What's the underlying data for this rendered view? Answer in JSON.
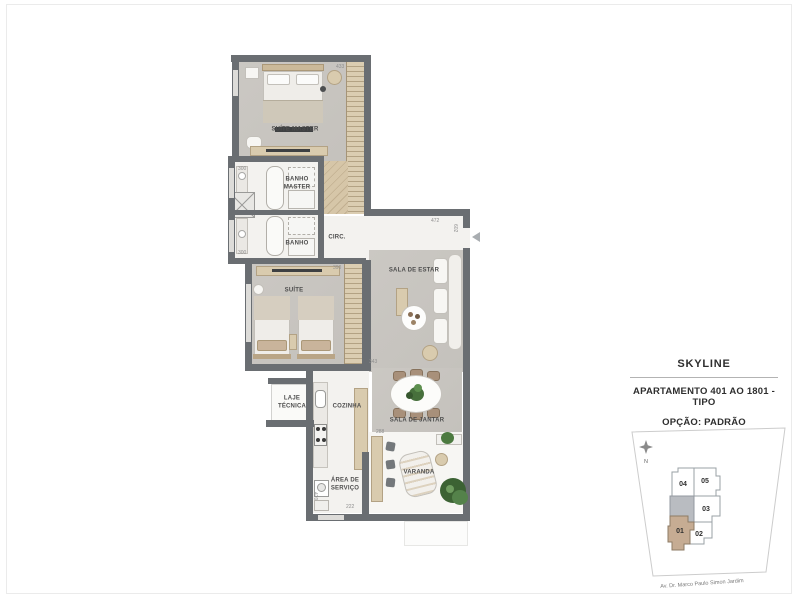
{
  "title_block": {
    "project_name": "SKYLINE",
    "apartment_line": "APARTAMENTO 401 AO 1801 - TIPO",
    "option_line": "OPÇÃO: PADRÃO"
  },
  "floor_plan": {
    "rooms": [
      {
        "id": "suite-master",
        "label": "SUÍTE MASTER"
      },
      {
        "id": "banho-master",
        "label": "BANHO MASTER"
      },
      {
        "id": "banho",
        "label": "BANHO"
      },
      {
        "id": "circ",
        "label": "CIRC."
      },
      {
        "id": "suite",
        "label": "SUÍTE"
      },
      {
        "id": "sala-de-estar",
        "label": "SALA DE ESTAR"
      },
      {
        "id": "sala-de-jantar",
        "label": "SALA DE JANTAR"
      },
      {
        "id": "laje-tecnica",
        "label": "LAJE TÉCNICA"
      },
      {
        "id": "cozinha",
        "label": "COZINHA"
      },
      {
        "id": "area-de-servico",
        "label": "ÁREA DE SERVIÇO"
      },
      {
        "id": "varanda",
        "label": "VARANDA"
      }
    ],
    "dimensions": [
      "433",
      "300",
      "300",
      "472",
      "602",
      "390",
      "343",
      "288",
      "420",
      "222"
    ],
    "colors": {
      "wall": "#6a6e72",
      "wood": "#d8c9ad",
      "concrete_floor": "#c9c6c1",
      "light_floor": "#f3f2ef"
    }
  },
  "key_plan": {
    "compass_label": "N",
    "street_label": "Av. Dr. Marco Paulo Simon Jardim",
    "units": [
      {
        "number": "04",
        "highlighted": false
      },
      {
        "number": "05",
        "highlighted": false
      },
      {
        "number": "03",
        "highlighted": false
      },
      {
        "number": "02",
        "highlighted": false
      },
      {
        "number": "01",
        "highlighted": true
      }
    ],
    "highlight_color": "#c6ac93",
    "core_color": "#b9bcc1"
  }
}
